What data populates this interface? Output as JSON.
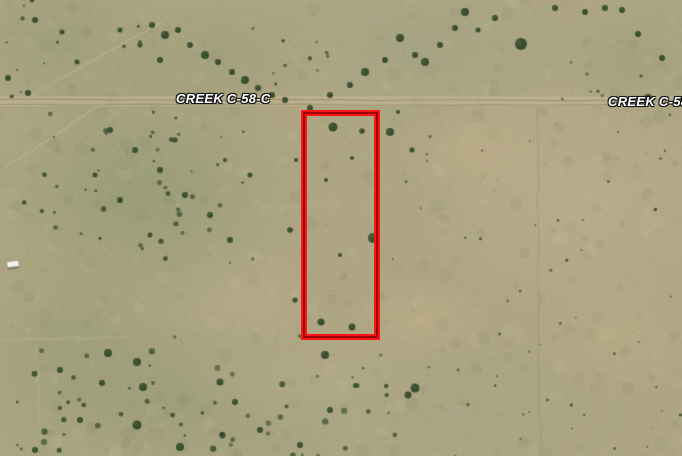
{
  "map": {
    "view_type": "satellite-imagery",
    "road_labels": [
      {
        "text": "CREEK C-58-C",
        "position": "left-of-parcel",
        "clipped": false
      },
      {
        "text": "CREEK C-58-C",
        "position": "right-edge",
        "clipped": true
      }
    ],
    "parcel_overlay": {
      "shape": "rectangle",
      "style": "double-red-outline"
    },
    "features": {
      "road": "dirt road running horizontally across upper third",
      "structure": "small white building near left edge",
      "vegetation": "scattered juniper trees and shrubs"
    },
    "colors": {
      "terrain_base": "#aea683",
      "terrain_green": "#8a9570",
      "terrain_graygreen": "#9aa083",
      "terrain_sand": "#c3b492",
      "terrain_pink": "#c6b08d",
      "road_surface": "#cbbc99",
      "trail": "#c6b794",
      "rut": "#80774f",
      "tree_dark": "#2e4527",
      "tree_light": "#4e6239",
      "building": "#f4f4ef",
      "parcel_red": "#ff1414",
      "parcel_dark_red": "#990404",
      "road_label_text": "#ffffff",
      "road_label_outline": "#151515"
    }
  }
}
